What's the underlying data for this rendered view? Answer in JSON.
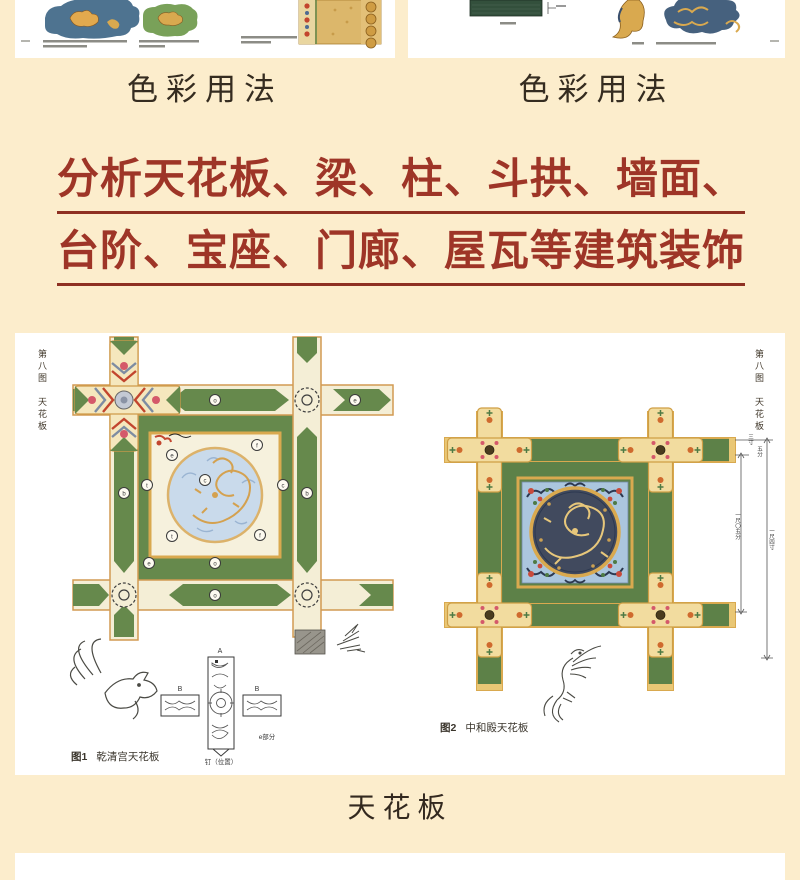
{
  "colors": {
    "background": "#fcedcc",
    "panel": "#ffffff",
    "headline_red": "#9e3527",
    "green": "#66894c",
    "green_dark": "#5d8148",
    "gold": "#d9a94f",
    "beam_cream": "#f4eed6",
    "blue_field": "#a9c4dd",
    "navy": "#3f485c"
  },
  "top": {
    "left_caption": "色彩用法",
    "right_caption": "色彩用法"
  },
  "headline": {
    "line1": "分析天花板、梁、柱、斗拱、墙面、",
    "line2": "台阶、宝座、门廊、屋瓦等建筑装饰"
  },
  "spread": {
    "margin_label_left": "第八图　天花板",
    "margin_label_right": "第八图　天花板",
    "fig1_no": "图1",
    "fig1_title": "乾清宫天花板",
    "fig2_no": "图2",
    "fig2_title": "中和殿天花板",
    "detail": {
      "a": "A",
      "b_left": "B",
      "b_right": "B",
      "part": "e部分",
      "position": "钉（位置）"
    },
    "dims": {
      "d1": "三寸",
      "d2": "五分",
      "d3": "一尺〇五分",
      "d4": "一尺四寸"
    },
    "markers": [
      "o",
      "f",
      "e",
      "t",
      "c",
      "c",
      "b",
      "b",
      "t",
      "f",
      "o",
      "e",
      "o",
      "e"
    ]
  },
  "footer_title": "天花板"
}
